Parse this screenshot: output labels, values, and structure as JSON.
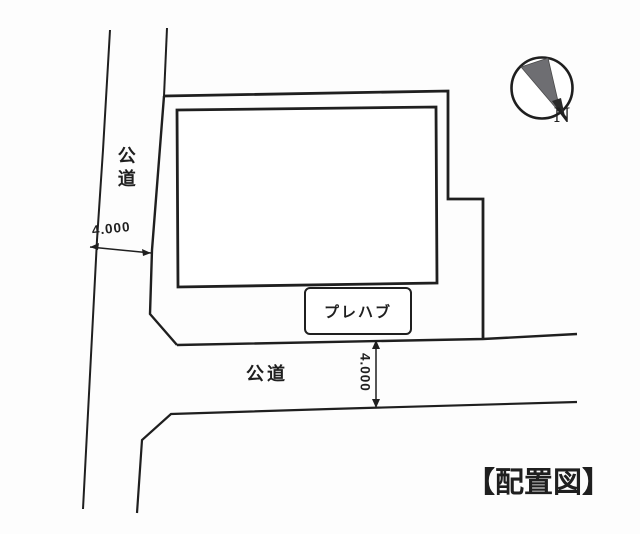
{
  "colors": {
    "ink": "#1f1f1f",
    "needle": "#6e6e72",
    "paper": "#fdfdfd"
  },
  "drawing": {
    "title": "【配置図】",
    "compass": {
      "label": "N"
    },
    "left_road": {
      "label": "公道",
      "width_dimension": "4.000"
    },
    "bottom_road": {
      "label": "公道",
      "width_dimension": "4.000"
    },
    "prefab": {
      "label": "プレハブ"
    }
  }
}
